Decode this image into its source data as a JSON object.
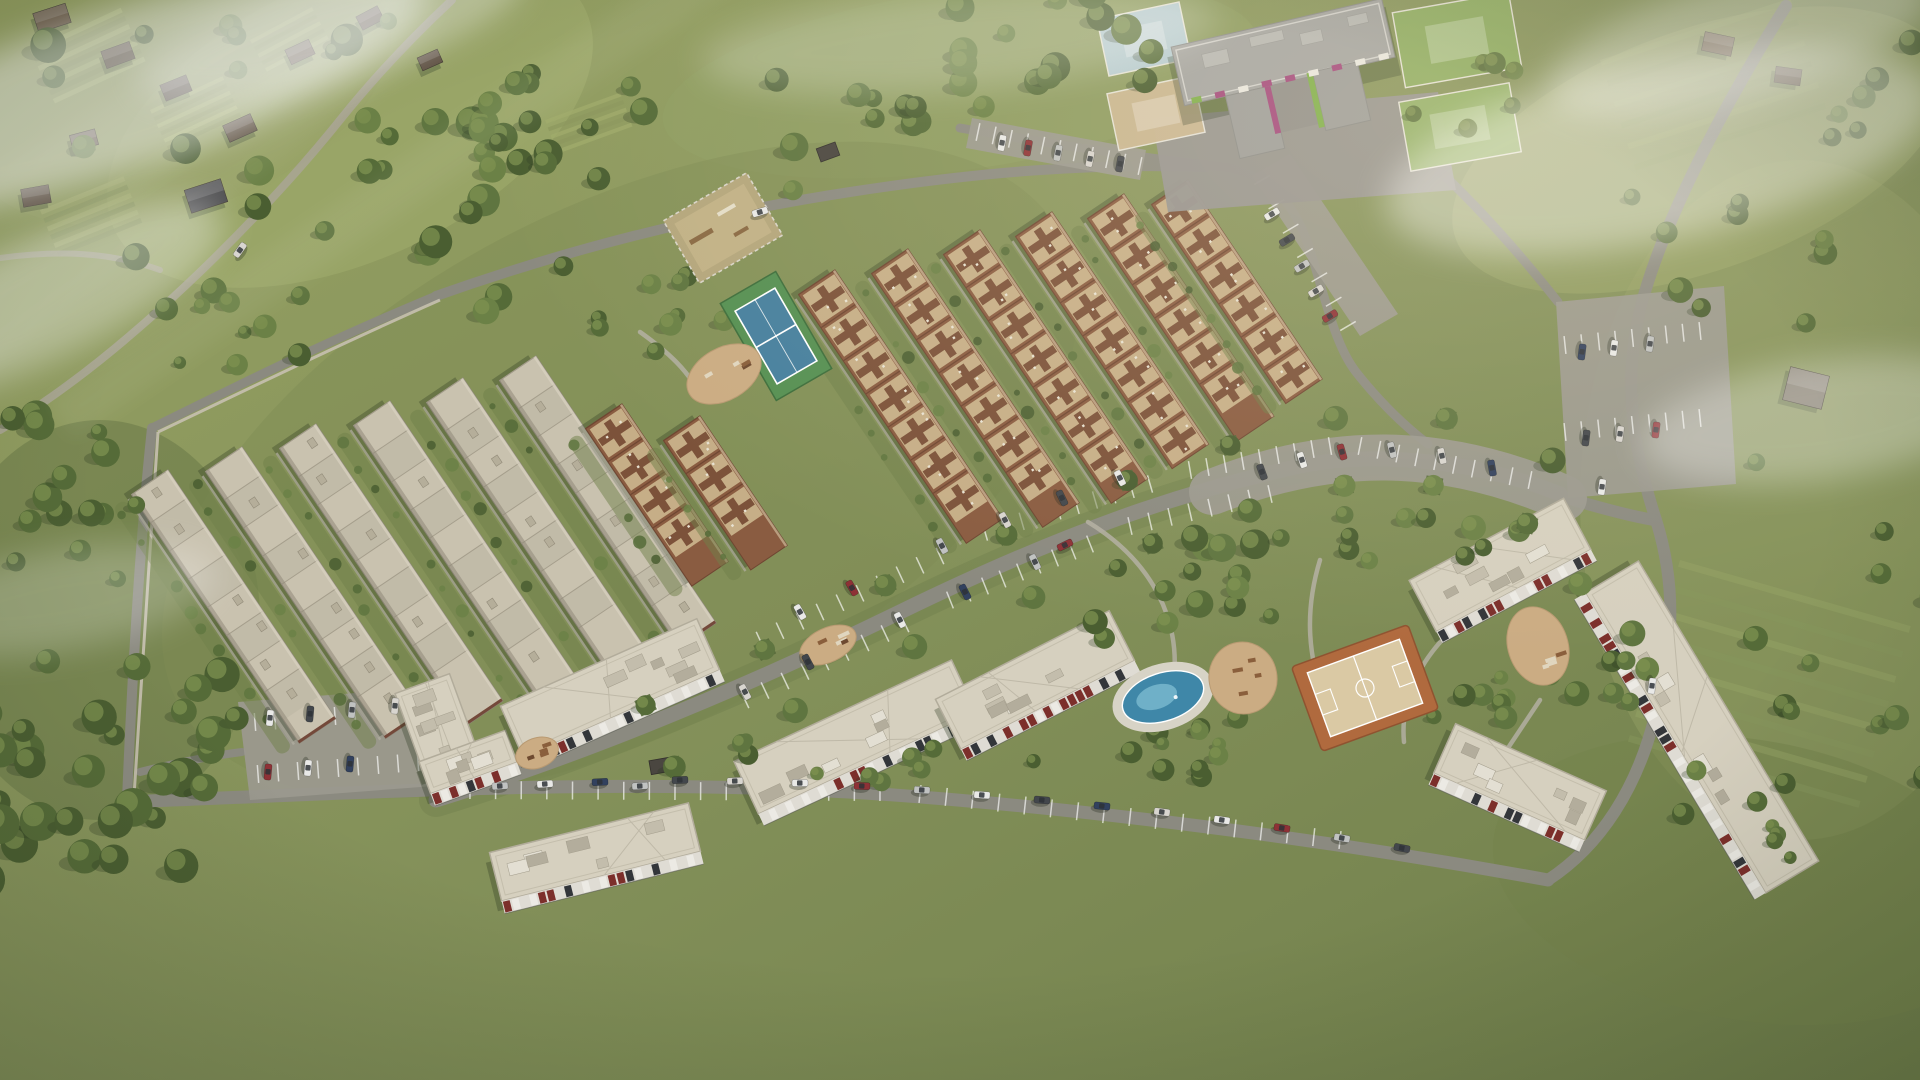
{
  "scene": {
    "kind": "aerial-masterplan-render",
    "canvas": {
      "w": 1920,
      "h": 1080
    }
  },
  "palette": {
    "grass": "#87925c",
    "grassLight": "#a2ad6e",
    "grassDark": "#5f6f42",
    "forest": "#465c31",
    "road": "#8b8a80",
    "roadLight": "#9b998e",
    "path": "#b3afa2",
    "wall": "#c6c0b0",
    "roofFlat": "#c9c2af",
    "roofFlatAlt": "#bdb6a3",
    "roofEdge": "#8b8577",
    "brick": "#74493a",
    "roofTan": "#c6ae87",
    "crossBrown": "#7c523a",
    "rowBase": "#8a5c41",
    "aptRoof": "#d6d0bf",
    "aptRoofEdge": "#b2ac9b",
    "facadeWhite": "#eceae4",
    "facadeWhite2": "#dfdcd4",
    "facadeRed": "#7c2f2b",
    "facadeDark": "#33363a",
    "kgRoof": "#a4a4a1",
    "kgPave": "#97948f",
    "kgGreen": "#7fae4a",
    "kgMagenta": "#a3487c",
    "tennisGreen": "#569053",
    "tennisBlue": "#47809e",
    "courtClay": "#b06a3e",
    "courtSand": "#dac9a4",
    "poolBlue": "#3f87a8",
    "poolLight": "#74b5cb",
    "sand": "#cbac83",
    "shed": "#4a4640",
    "treeTones": [
      "#4a5e31",
      "#556b38",
      "#5f7540",
      "#6b8146"
    ],
    "treeHighlight": "#7e9150",
    "treeShadow": "#2c3820",
    "carColors": [
      "#e9e9e7",
      "#c0c2c1",
      "#43474c",
      "#8e3136",
      "#32415e",
      "#d8d5cf"
    ]
  },
  "terrain_patches": [
    [
      350,
      120,
      260,
      140,
      -25,
      "#a2ad6e",
      0.5
    ],
    [
      100,
      620,
      160,
      200,
      0,
      "#6d7c49",
      0.6
    ],
    [
      960,
      80,
      300,
      90,
      -8,
      "#90a063",
      0.5
    ],
    [
      1800,
      500,
      220,
      340,
      0,
      "#8d9a60",
      0.6
    ],
    [
      1700,
      150,
      260,
      120,
      -20,
      "#a2ad6e",
      0.4
    ],
    [
      620,
      470,
      500,
      260,
      -28,
      "#7f8c54",
      0.45
    ],
    [
      1750,
      880,
      260,
      140,
      10,
      "#74834c",
      0.55
    ],
    [
      180,
      90,
      220,
      120,
      -20,
      "#97a266",
      0.5
    ]
  ],
  "field_patches": [
    [
      30,
      50,
      100,
      5,
      -25,
      7,
      9,
      "#aab573",
      "#8e9a5f",
      0.8
    ],
    [
      150,
      110,
      80,
      4,
      -25,
      6,
      8,
      "#aab573",
      "#8e9a5f",
      0.8
    ],
    [
      40,
      210,
      90,
      5,
      -22,
      6,
      9,
      "#a3ad6e",
      "#8a965c",
      0.8
    ],
    [
      250,
      40,
      70,
      4,
      -28,
      5,
      8,
      "#aab573",
      "#8e9a5f",
      0.8
    ],
    [
      545,
      120,
      80,
      4,
      -20,
      5,
      8,
      "#9fab6b",
      "#8a965c",
      0.7
    ],
    [
      1680,
      560,
      240,
      7,
      16,
      8,
      26,
      "#93a164",
      "#86955b",
      0.5
    ],
    [
      1600,
      60,
      200,
      6,
      -18,
      6,
      22,
      "#9aa768",
      "#8a975e",
      0.45
    ]
  ],
  "village_houses": [
    [
      52,
      18,
      34,
      20,
      -18,
      "#6b5a47"
    ],
    [
      118,
      55,
      30,
      18,
      -20,
      "#55483a"
    ],
    [
      176,
      88,
      28,
      17,
      -22,
      "#4e4238"
    ],
    [
      240,
      128,
      30,
      18,
      -24,
      "#5d4f40"
    ],
    [
      84,
      140,
      26,
      16,
      -15,
      "#6e6052"
    ],
    [
      36,
      196,
      28,
      18,
      -10,
      "#584a3c"
    ],
    [
      206,
      196,
      38,
      24,
      -18,
      "#4a4a4c"
    ],
    [
      300,
      52,
      26,
      16,
      -25,
      "#635445"
    ],
    [
      370,
      18,
      24,
      15,
      -28,
      "#56493c"
    ],
    [
      430,
      60,
      22,
      14,
      -24,
      "#605244"
    ],
    [
      1718,
      44,
      30,
      19,
      12,
      "#6b5a47"
    ],
    [
      1788,
      76,
      26,
      16,
      8,
      "#584a3c"
    ],
    [
      1806,
      388,
      40,
      34,
      14,
      "#7b7467"
    ]
  ],
  "sheds": [
    [
      828,
      152,
      -20
    ],
    [
      660,
      766,
      -10
    ]
  ],
  "rural_roads": [
    {
      "d": "M0,430 C120,360 260,220 340,120 C380,70 420,30 452,0",
      "w": 8,
      "c": "#a9a495",
      "o": 0.85
    },
    {
      "d": "M0,258 C60,250 110,252 160,270",
      "w": 6,
      "c": "#a9a495",
      "o": 0.7
    }
  ],
  "verges": [
    {
      "d": "M436,800 C560,762 720,700 900,612 C1060,534 1180,492 1300,466 C1380,450 1480,462 1560,494",
      "w": 34,
      "c": "#6d7e4a",
      "o": 0.4
    }
  ],
  "roads": [
    {
      "d": "M126,802 C420,790 640,778 880,794 C1080,808 1320,838 1548,880",
      "w": 13
    },
    {
      "d": "M152,428 C140,540 132,680 127,800",
      "w": 10
    },
    {
      "d": "M152,428 C245,382 330,340 436,296",
      "w": 9
    },
    {
      "d": "M436,296 C560,252 700,215 850,192 C980,172 1090,163 1205,167",
      "w": 10
    },
    {
      "d": "M1230,168 C1272,178 1294,204 1308,244 C1324,292 1334,344 1356,372 C1378,400 1402,424 1428,444",
      "w": 9
    },
    {
      "d": "M436,800 C560,762 720,700 900,612 C1060,534 1180,492 1300,466 C1380,450 1480,462 1560,494",
      "w": 15
    },
    {
      "d": "M1786,6 C1716,118 1660,230 1640,310 C1622,386 1634,452 1656,520 C1678,590 1672,650 1656,712 C1638,788 1600,846 1548,880",
      "w": 12
    },
    {
      "d": "M960,128 C1040,142 1140,158 1232,168",
      "w": 9
    },
    {
      "d": "M1430,162 C1478,206 1520,254 1558,302",
      "w": 9
    },
    {
      "d": "M1560,496 C1600,508 1630,516 1654,520",
      "w": 12
    },
    {
      "d": "M140,772 C180,762 210,756 242,752",
      "w": 8
    }
  ],
  "walls": [
    {
      "d": "M158,432 C150,552 141,682 134,796"
    },
    {
      "d": "M158,432 C250,388 336,346 440,300"
    }
  ],
  "footpaths": [
    {
      "d": "M640,332 C668,352 690,372 700,396"
    },
    {
      "d": "M1088,522 C1150,560 1185,620 1172,692"
    },
    {
      "d": "M1320,560 C1306,606 1306,650 1324,700"
    },
    {
      "d": "M1452,630 C1420,660 1400,700 1404,742"
    },
    {
      "d": "M1540,700 C1520,730 1500,760 1480,790"
    }
  ],
  "lots": [
    [
      [
        972,
        118
      ],
      [
        1146,
        150
      ],
      [
        1140,
        180
      ],
      [
        966,
        148
      ]
    ],
    [
      [
        1556,
        302
      ],
      [
        1724,
        286
      ],
      [
        1736,
        484
      ],
      [
        1568,
        498
      ]
    ],
    [
      [
        238,
        702
      ],
      [
        422,
        688
      ],
      [
        434,
        786
      ],
      [
        250,
        800
      ]
    ],
    [
      [
        1252,
        176
      ],
      [
        1290,
        154
      ],
      [
        1398,
        314
      ],
      [
        1360,
        336
      ]
    ]
  ],
  "lot_bands": [
    {
      "d": "M1212,492 C1330,446 1440,444 1564,498",
      "w": 46
    }
  ],
  "stall_rows": [
    [
      [
        978,
        132
      ],
      [
        1140,
        166
      ],
      10
    ],
    [
      [
        1565,
        345
      ],
      [
        1700,
        331
      ],
      8
    ],
    [
      [
        1565,
        432
      ],
      [
        1700,
        418
      ],
      8
    ],
    [
      [
        760,
        640
      ],
      [
        940,
        556
      ],
      9
    ],
    [
      [
        985,
        532
      ],
      [
        1150,
        484
      ],
      9
    ],
    [
      [
        1190,
        470
      ],
      [
        1330,
        446
      ],
      8
    ],
    [
      [
        745,
        700
      ],
      [
        905,
        624
      ],
      8
    ],
    [
      [
        950,
        600
      ],
      [
        1090,
        544
      ],
      8
    ],
    [
      [
        1130,
        526
      ],
      [
        1270,
        494
      ],
      7
    ],
    [
      [
        1360,
        446
      ],
      [
        1530,
        480
      ],
      9
    ],
    [
      [
        255,
        722
      ],
      [
        415,
        710
      ],
      8
    ],
    [
      [
        258,
        774
      ],
      [
        418,
        762
      ],
      8
    ],
    [
      [
        470,
        790
      ],
      [
        880,
        792
      ],
      16
    ],
    [
      [
        920,
        794
      ],
      [
        1340,
        840
      ],
      16
    ],
    [
      [
        1262,
        180
      ],
      [
        1348,
        326
      ],
      6
    ]
  ],
  "rows_format": "x,y,len,style(0=flat,1=cross)",
  "row_angle": 56,
  "row_width": 44,
  "townhouse_rows": [
    [
      168,
      470,
      300,
      0
    ],
    [
      242,
      447,
      322,
      0
    ],
    [
      316,
      424,
      334,
      0
    ],
    [
      390,
      401,
      336,
      0
    ],
    [
      463,
      378,
      330,
      0
    ],
    [
      536,
      356,
      322,
      0
    ],
    [
      622,
      404,
      190,
      1
    ],
    [
      700,
      416,
      156,
      1
    ],
    [
      835,
      270,
      300,
      1
    ],
    [
      908,
      249,
      306,
      1
    ],
    [
      980,
      230,
      300,
      1
    ],
    [
      1052,
      212,
      280,
      1
    ],
    [
      1124,
      194,
      268,
      1
    ],
    [
      1188,
      180,
      240,
      1
    ]
  ],
  "apartments_format": "cx,cy,len,width,rot",
  "apartments": [
    [
      437,
      724,
      58,
      86,
      -20
    ],
    [
      468,
      762,
      92,
      34,
      -20
    ],
    [
      610,
      688,
      215,
      56,
      -24
    ],
    [
      855,
      737,
      240,
      58,
      -25
    ],
    [
      1035,
      680,
      195,
      56,
      -27
    ],
    [
      595,
      852,
      205,
      50,
      -14
    ],
    [
      1500,
      565,
      175,
      58,
      -28
    ],
    [
      1702,
      727,
      350,
      62,
      59
    ],
    [
      1520,
      782,
      165,
      54,
      24
    ]
  ],
  "kindergarten": {
    "cx": 1284,
    "cy": 56,
    "rot": -13,
    "apron": [
      [
        1152,
        118
      ],
      [
        1438,
        92
      ],
      [
        1456,
        190
      ],
      [
        1168,
        212
      ]
    ],
    "plays": [
      [
        1102,
        10,
        84,
        58,
        -12,
        "#b7cdd6"
      ],
      [
        1112,
        84,
        88,
        58,
        -12,
        "#ccb792"
      ],
      [
        1398,
        2,
        118,
        76,
        -10,
        "#8fae62"
      ],
      [
        1404,
        92,
        112,
        70,
        -10,
        "#93b267"
      ]
    ]
  },
  "amenities": {
    "tennis": {
      "cx": 776,
      "cy": 336,
      "w": 64,
      "h": 112,
      "rot": -30
    },
    "dog_park": {
      "cx": 723,
      "cy": 228,
      "w": 96,
      "h": 72,
      "rot": -30
    },
    "basketball": {
      "cx": 1365,
      "cy": 688,
      "w": 124,
      "h": 90,
      "rot": -20
    },
    "splash_pool": {
      "cx": 1163,
      "cy": 697,
      "rx": 42,
      "ry": 24,
      "rot": -18
    },
    "sand_areas": [
      [
        724,
        374,
        40,
        26,
        -30
      ],
      [
        1243,
        678,
        34,
        36,
        -10
      ],
      [
        1538,
        646,
        30,
        40,
        -18
      ],
      [
        537,
        753,
        22,
        15,
        -20
      ],
      [
        828,
        645,
        30,
        17,
        -25
      ]
    ]
  },
  "tree_clusters_format": "cx,cy,rx,ry,count,rmin,rmax,dark",
  "tree_clusters": [
    [
      95,
      770,
      150,
      110,
      34,
      10,
      20,
      1
    ],
    [
      60,
      480,
      85,
      150,
      16,
      8,
      16,
      1
    ],
    [
      300,
      165,
      290,
      150,
      26,
      8,
      18,
      0
    ],
    [
      700,
      128,
      220,
      65,
      20,
      8,
      15,
      0
    ],
    [
      1040,
      58,
      115,
      65,
      15,
      9,
      17,
      0
    ],
    [
      640,
      300,
      90,
      55,
      11,
      7,
      13,
      0
    ],
    [
      1200,
      580,
      110,
      60,
      16,
      8,
      15,
      0
    ],
    [
      1430,
      555,
      90,
      45,
      10,
      8,
      14,
      0
    ],
    [
      1180,
      745,
      70,
      35,
      8,
      7,
      12,
      0
    ],
    [
      1480,
      700,
      50,
      40,
      7,
      7,
      12,
      0
    ],
    [
      1600,
      650,
      60,
      70,
      9,
      7,
      13,
      0
    ],
    [
      1000,
      758,
      280,
      30,
      14,
      6,
      11,
      0
    ],
    [
      1730,
      260,
      110,
      80,
      9,
      8,
      14,
      0
    ],
    [
      1810,
      640,
      130,
      190,
      11,
      7,
      14,
      0
    ],
    [
      1870,
      95,
      55,
      55,
      6,
      8,
      13,
      0
    ],
    [
      480,
      120,
      120,
      70,
      10,
      7,
      14,
      0
    ],
    [
      1460,
      90,
      60,
      40,
      6,
      7,
      12,
      0
    ],
    [
      1790,
      740,
      40,
      120,
      8,
      6,
      11,
      0
    ],
    [
      280,
      330,
      130,
      40,
      9,
      6,
      12,
      0
    ]
  ],
  "street_trees": {
    "pts": [
      [
        660,
        736
      ],
      [
        780,
        680
      ],
      [
        900,
        616
      ],
      [
        1020,
        566
      ],
      [
        1140,
        512
      ],
      [
        1240,
        478
      ],
      [
        1340,
        452
      ],
      [
        1440,
        452
      ],
      [
        1540,
        492
      ]
    ],
    "offset": 34
  },
  "cars_format": "x,y,rot,colorIndex",
  "cars": [
    [
      1002,
      143,
      100,
      0
    ],
    [
      1028,
      148,
      100,
      3
    ],
    [
      1058,
      153,
      101,
      1
    ],
    [
      1090,
      159,
      101,
      5
    ],
    [
      1120,
      164,
      100,
      2
    ],
    [
      1582,
      352,
      97,
      4
    ],
    [
      1614,
      348,
      97,
      0
    ],
    [
      1650,
      344,
      97,
      1
    ],
    [
      1586,
      438,
      97,
      2
    ],
    [
      1620,
      434,
      97,
      5
    ],
    [
      1656,
      430,
      97,
      3
    ],
    [
      1602,
      487,
      97,
      0
    ],
    [
      800,
      612,
      60,
      0
    ],
    [
      852,
      588,
      60,
      3
    ],
    [
      942,
      546,
      62,
      1
    ],
    [
      1005,
      520,
      62,
      5
    ],
    [
      1062,
      498,
      64,
      2
    ],
    [
      1120,
      478,
      64,
      0
    ],
    [
      745,
      692,
      62,
      5
    ],
    [
      808,
      662,
      62,
      2
    ],
    [
      900,
      620,
      63,
      0
    ],
    [
      965,
      592,
      63,
      4
    ],
    [
      1035,
      562,
      64,
      1
    ],
    [
      1262,
      472,
      70,
      2
    ],
    [
      1302,
      460,
      72,
      0
    ],
    [
      1342,
      452,
      74,
      3
    ],
    [
      1392,
      450,
      76,
      1
    ],
    [
      1442,
      456,
      78,
      5
    ],
    [
      1492,
      468,
      80,
      4
    ],
    [
      270,
      718,
      95,
      0
    ],
    [
      310,
      714,
      95,
      2
    ],
    [
      352,
      710,
      95,
      1
    ],
    [
      395,
      706,
      95,
      5
    ],
    [
      268,
      772,
      95,
      3
    ],
    [
      308,
      768,
      95,
      0
    ],
    [
      350,
      764,
      95,
      4
    ],
    [
      500,
      786,
      -4,
      1
    ],
    [
      545,
      784,
      -4,
      0
    ],
    [
      600,
      782,
      -3,
      4
    ],
    [
      680,
      780,
      -2,
      2
    ],
    [
      735,
      781,
      -2,
      5
    ],
    [
      800,
      783,
      0,
      0
    ],
    [
      862,
      786,
      2,
      3
    ],
    [
      922,
      790,
      3,
      1
    ],
    [
      982,
      795,
      4,
      0
    ],
    [
      1042,
      800,
      5,
      2
    ],
    [
      1102,
      806,
      6,
      4
    ],
    [
      1162,
      812,
      7,
      5
    ],
    [
      1222,
      820,
      8,
      0
    ],
    [
      1282,
      828,
      9,
      3
    ],
    [
      1342,
      838,
      10,
      1
    ],
    [
      1402,
      848,
      11,
      2
    ],
    [
      1272,
      214,
      -31,
      0
    ],
    [
      1287,
      240,
      -31,
      2
    ],
    [
      1302,
      266,
      -31,
      1
    ],
    [
      1316,
      291,
      -31,
      5
    ],
    [
      1330,
      316,
      -31,
      3
    ],
    [
      760,
      212,
      -17,
      0
    ],
    [
      1065,
      545,
      -26,
      3
    ],
    [
      640,
      786,
      -3,
      1
    ],
    [
      240,
      250,
      -55,
      5
    ],
    [
      1652,
      686,
      97,
      0
    ]
  ],
  "fog": [
    [
      120,
      90,
      320,
      80,
      -18,
      0.5
    ],
    [
      40,
      300,
      200,
      60,
      -25,
      0.35
    ],
    [
      330,
      30,
      200,
      50,
      -15,
      0.3
    ],
    [
      1660,
      150,
      280,
      90,
      -12,
      0.4
    ],
    [
      1820,
      420,
      180,
      60,
      -8,
      0.3
    ],
    [
      1740,
      40,
      200,
      60,
      -15,
      0.35
    ],
    [
      60,
      600,
      160,
      50,
      -10,
      0.22
    ],
    [
      960,
      40,
      260,
      50,
      -5,
      0.22
    ]
  ],
  "rays": [
    {
      "d": "M520,-50 L-150,420",
      "w": 70,
      "o": 0.06
    },
    {
      "d": "M760,-60 L60,420",
      "w": 46,
      "o": 0.05
    },
    {
      "d": "M420,-40 L-250,380",
      "w": 90,
      "o": 0.05
    }
  ]
}
